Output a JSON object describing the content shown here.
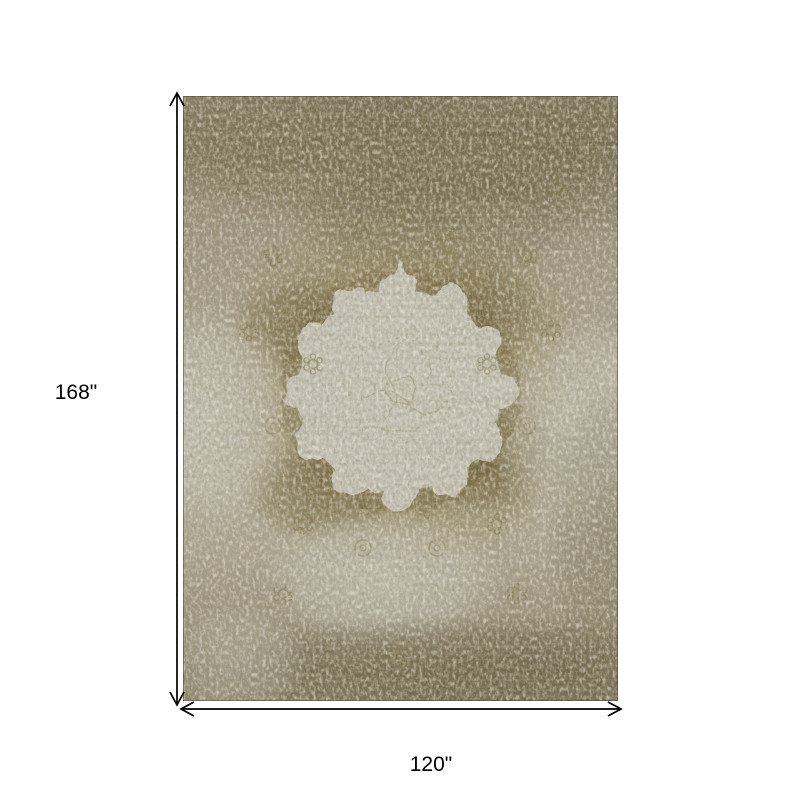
{
  "page": {
    "background_color": "#ffffff"
  },
  "diagram": {
    "kind": "product-dimension-diagram",
    "height_label": "168\"",
    "width_label": "120\"",
    "height_inches": 168,
    "width_inches": 120,
    "unit": "inches",
    "arrow_color": "#000000",
    "label_color": "#000000",
    "rug": {
      "style": "distressed-vintage-medallion-rug",
      "colors": {
        "base_taupe": "#a59d8a",
        "dark_olive": "#6f664a",
        "gold_brown": "#8b7b4b",
        "dark_brown": "#6a5c36",
        "medallion_gray": "#c8c5ba",
        "light_patch": "#bfbcb1"
      }
    }
  }
}
